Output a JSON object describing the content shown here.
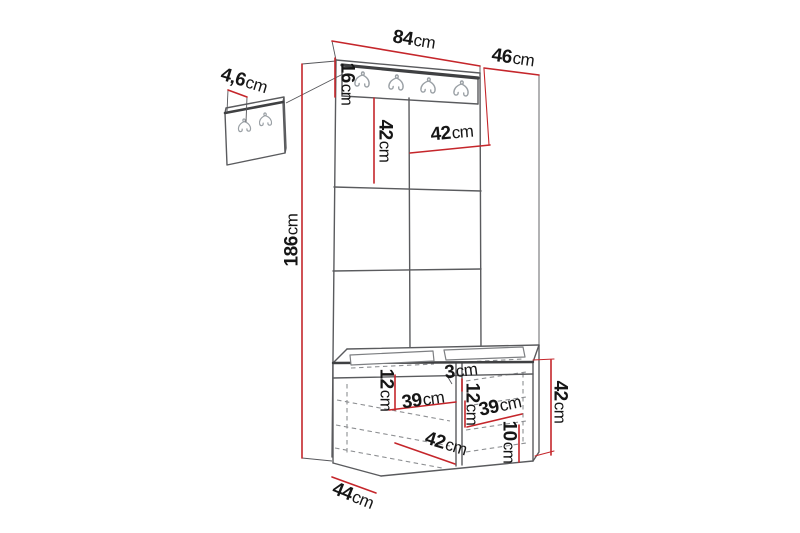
{
  "diagram": {
    "kind": "furniture-dimension-drawing",
    "unit_system": "cm",
    "hook_rail_hook_count": 4,
    "wall_panel_hook_count": 2
  },
  "colors": {
    "background": "#ffffff",
    "outline": "#5a5b5e",
    "outline_dark": "#3f4042",
    "hidden_line": "#8d8f92",
    "hook": "#9aa0a5",
    "dimension_line": "#c5262b",
    "label_text": "#161616"
  },
  "dimensions": {
    "width_top": {
      "value": "84",
      "unit": "cm"
    },
    "depth_top": {
      "value": "46",
      "unit": "cm"
    },
    "hook_rail_height": {
      "value": "16",
      "unit": "cm"
    },
    "panel_tile_left": {
      "value": "42",
      "unit": "cm"
    },
    "panel_tile_right": {
      "value": "42",
      "unit": "cm"
    },
    "total_height": {
      "value": "186",
      "unit": "cm"
    },
    "wall_panel_thickness": {
      "value": "4,6",
      "unit": "cm"
    },
    "divider_thickness": {
      "value": "3",
      "unit": "cm"
    },
    "shelf_drop_left": {
      "value": "12",
      "unit": "cm"
    },
    "compartment_left_width": {
      "value": "39",
      "unit": "cm"
    },
    "shelf_drop_right": {
      "value": "12",
      "unit": "cm"
    },
    "compartment_right_width": {
      "value": "39",
      "unit": "cm"
    },
    "plinth_height": {
      "value": "10",
      "unit": "cm"
    },
    "opening_width": {
      "value": "42",
      "unit": "cm"
    },
    "bench_height": {
      "value": "42",
      "unit": "cm"
    },
    "bench_depth": {
      "value": "44",
      "unit": "cm"
    }
  }
}
